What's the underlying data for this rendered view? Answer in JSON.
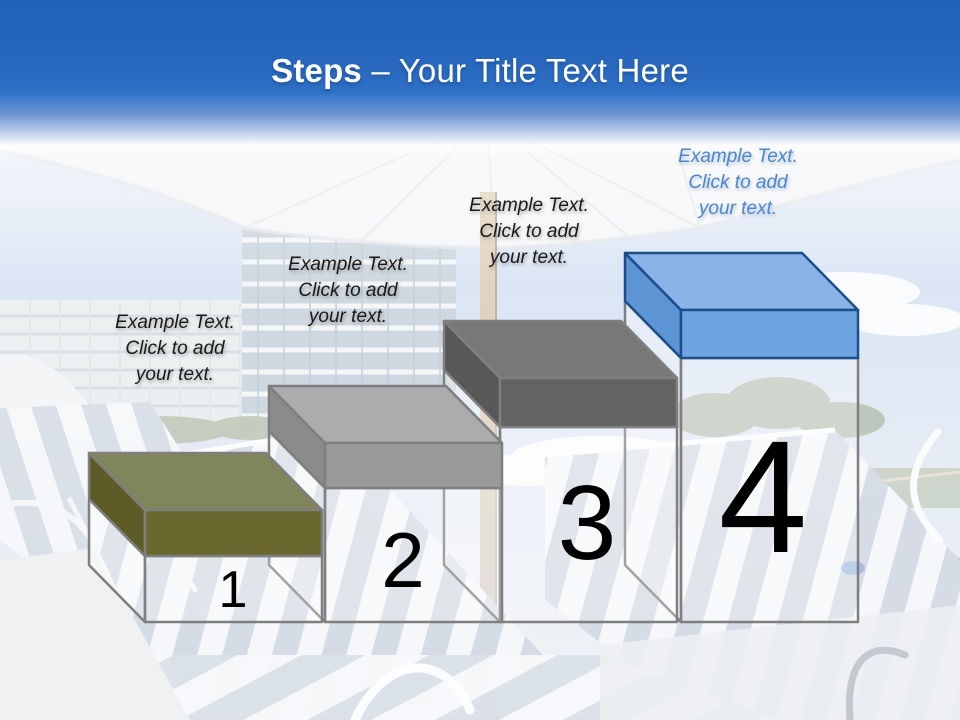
{
  "title": {
    "emphasis": "Steps",
    "separator": "–",
    "rest": "Your Title Text Here"
  },
  "theme": {
    "header_blue": "#2767bd",
    "outline_gray": "#7f7f7f"
  },
  "steps": [
    {
      "number": "1",
      "label": "Example Text.\nClick  to add\nyour text.",
      "label_color": "#1a1a1a",
      "colors": {
        "top": "#81855c",
        "front": "#6a682f",
        "left": "#5d5c26",
        "outline": "#7f7f7f"
      }
    },
    {
      "number": "2",
      "label": "Example Text.\nClick  to add\nyour text.",
      "label_color": "#1a1a1a",
      "colors": {
        "top": "#acacac",
        "front": "#9a9a9a",
        "left": "#8b8b8b",
        "outline": "#7f7f7f"
      }
    },
    {
      "number": "3",
      "label": "Example Text.\nClick  to add\nyour text.",
      "label_color": "#1a1a1a",
      "colors": {
        "top": "#787878",
        "front": "#636363",
        "left": "#585858",
        "outline": "#7f7f7f"
      }
    },
    {
      "number": "4",
      "label": "Example Text.\nClick  to add\nyour text.",
      "label_color": "#4d87cb",
      "colors": {
        "top": "#8ab4e8",
        "front": "#6fa4e2",
        "left": "#5d94d4",
        "outline": "#1b4e8c"
      }
    }
  ]
}
